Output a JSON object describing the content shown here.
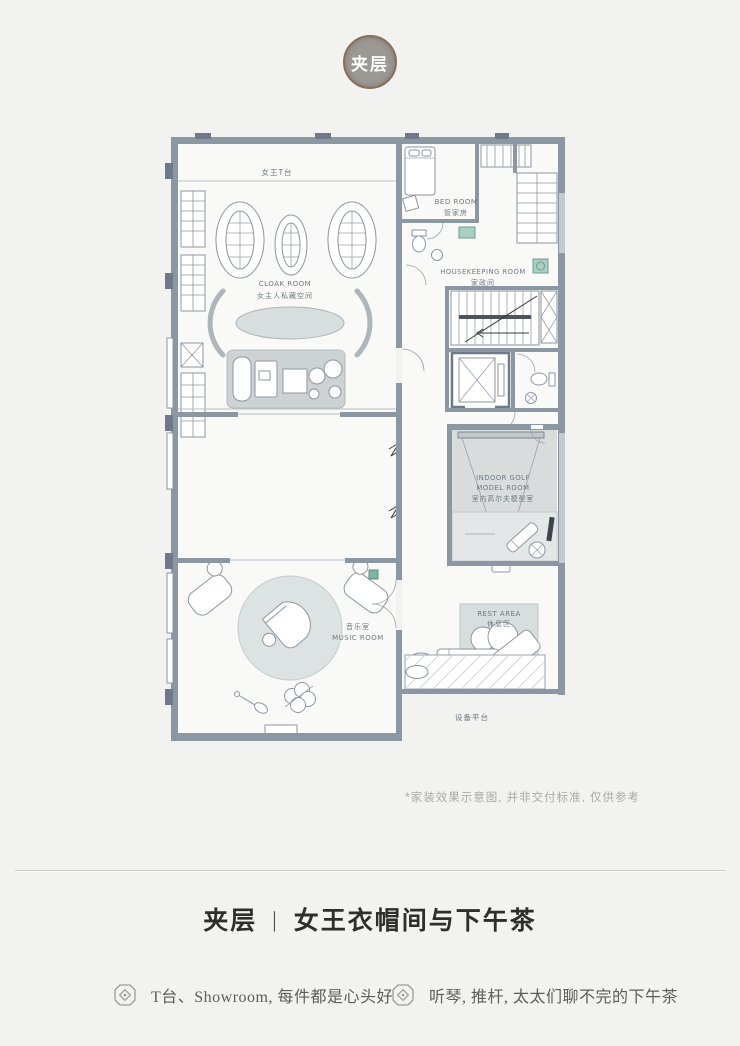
{
  "badge": {
    "label": "夹层"
  },
  "plan": {
    "rooms": {
      "runway": {
        "label_cn": "女王T台"
      },
      "cloak": {
        "label_en": "CLOAK ROOM",
        "label_cn": "女主人私藏空间"
      },
      "bed": {
        "label_en": "BED ROOM",
        "label_cn": "管家房"
      },
      "housekeeping": {
        "label_en": "HOUSEKEEPING ROOM",
        "label_cn": "家政间"
      },
      "golf": {
        "label_en_1": "INDOOR GOLF",
        "label_en_2": "MODEL ROOM",
        "label_cn": "室内高尔夫模型室"
      },
      "music": {
        "label_cn": "音乐室",
        "label_en": "MUSIC ROOM"
      },
      "rest": {
        "label_en": "REST AREA",
        "label_cn": "休息区"
      },
      "platform": {
        "label_cn": "设备平台"
      }
    },
    "colors": {
      "wall": "#8c97a4",
      "wall_dark": "#6e7a89",
      "floor": "#f9f9f8",
      "rug": "#d8dedd",
      "rug_dark": "#cdd3d4",
      "screen_area": "#d9dcdd",
      "accent_teal": "#7fb3a4",
      "badge_ring": "#8a6e56",
      "badge_fill": "#9c9995"
    }
  },
  "disclaimer": "*家装效果示意图, 并非交付标准, 仅供参考",
  "title": {
    "floor": "夹层",
    "separator": "|",
    "name": "女王衣帽间与下午茶"
  },
  "bullets": [
    {
      "icon": "diamond-seal-icon",
      "text": "T台、Showroom, 每件都是心头好"
    },
    {
      "icon": "diamond-seal-icon",
      "text": "听琴, 推杆, 太太们聊不完的下午茶"
    }
  ]
}
